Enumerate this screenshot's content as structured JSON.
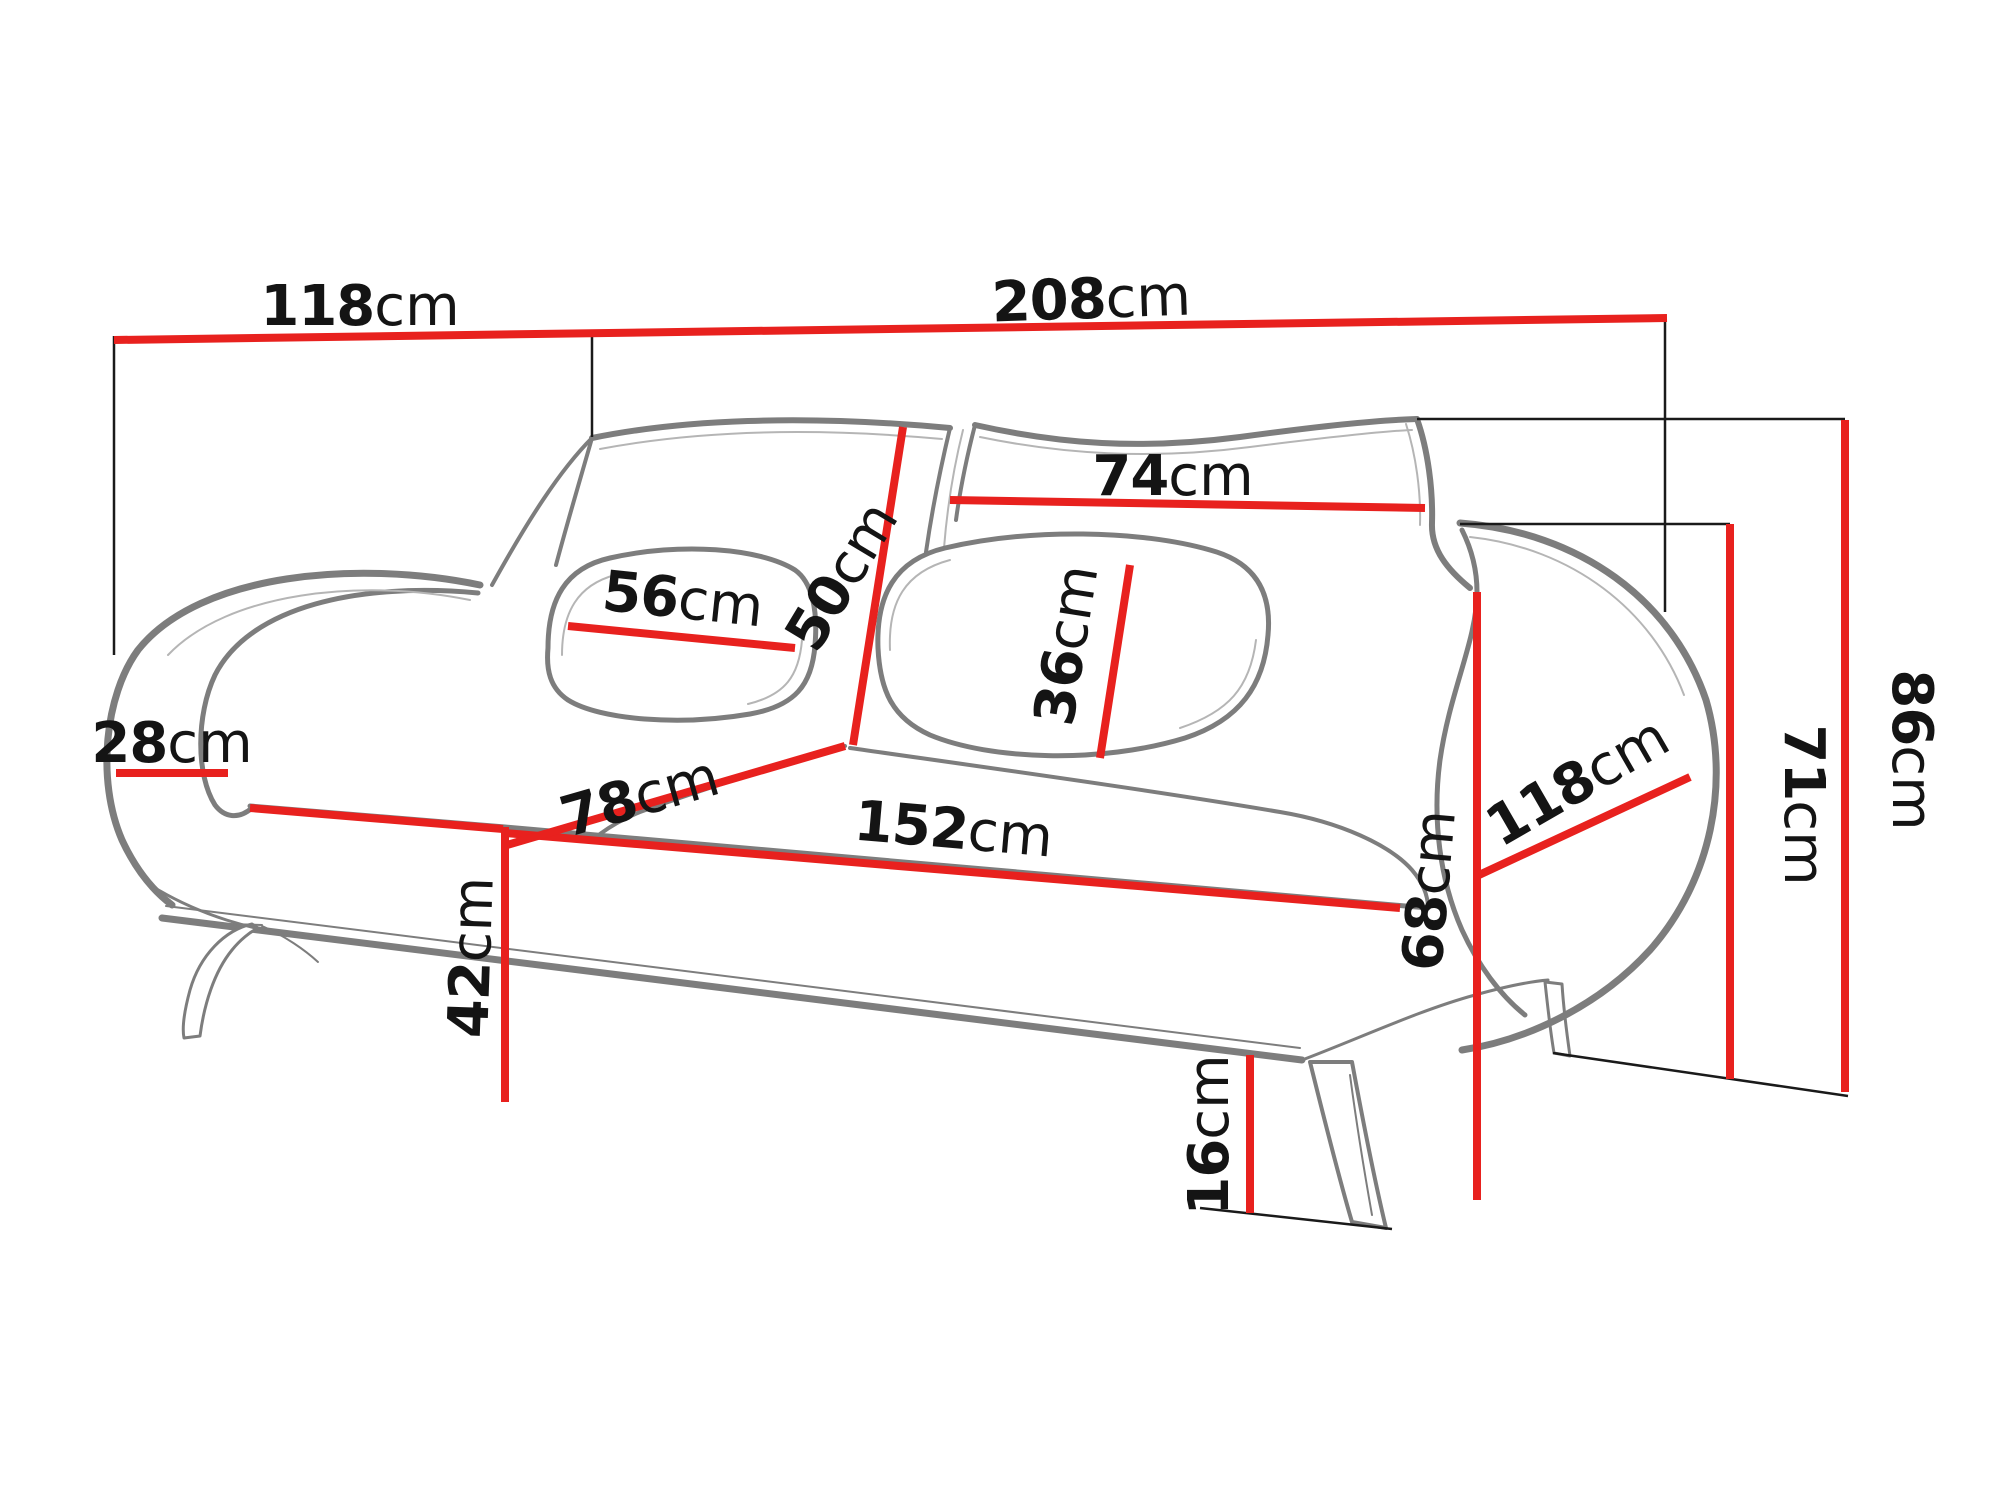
{
  "figure": {
    "kind": "sofa dimension diagram",
    "unit": "cm"
  },
  "colors": {
    "background": "#ffffff",
    "dimension_red": "#e8211e",
    "sketch_gray": "#7d7d7d",
    "sketch_light_gray": "#b5b5b5",
    "text_black": "#141414"
  },
  "dimensions": {
    "total_depth": {
      "value": "118",
      "unit": "cm"
    },
    "total_width": {
      "value": "208",
      "unit": "cm"
    },
    "right_backrest_width": {
      "value": "74",
      "unit": "cm"
    },
    "left_pillow_width": {
      "value": "56",
      "unit": "cm"
    },
    "backrest_cushion_height": {
      "value": "50",
      "unit": "cm"
    },
    "right_pillow_height": {
      "value": "36",
      "unit": "cm"
    },
    "armrest_width": {
      "value": "28",
      "unit": "cm"
    },
    "seat_depth": {
      "value": "78",
      "unit": "cm"
    },
    "seat_width": {
      "value": "152",
      "unit": "cm"
    },
    "seat_height": {
      "value": "42",
      "unit": "cm"
    },
    "armrest_height": {
      "value": "68",
      "unit": "cm"
    },
    "side_diagonal_depth": {
      "value": "118",
      "unit": "cm"
    },
    "leg_height": {
      "value": "16",
      "unit": "cm"
    },
    "backrest_height": {
      "value": "71",
      "unit": "cm"
    },
    "total_height": {
      "value": "86",
      "unit": "cm"
    }
  }
}
